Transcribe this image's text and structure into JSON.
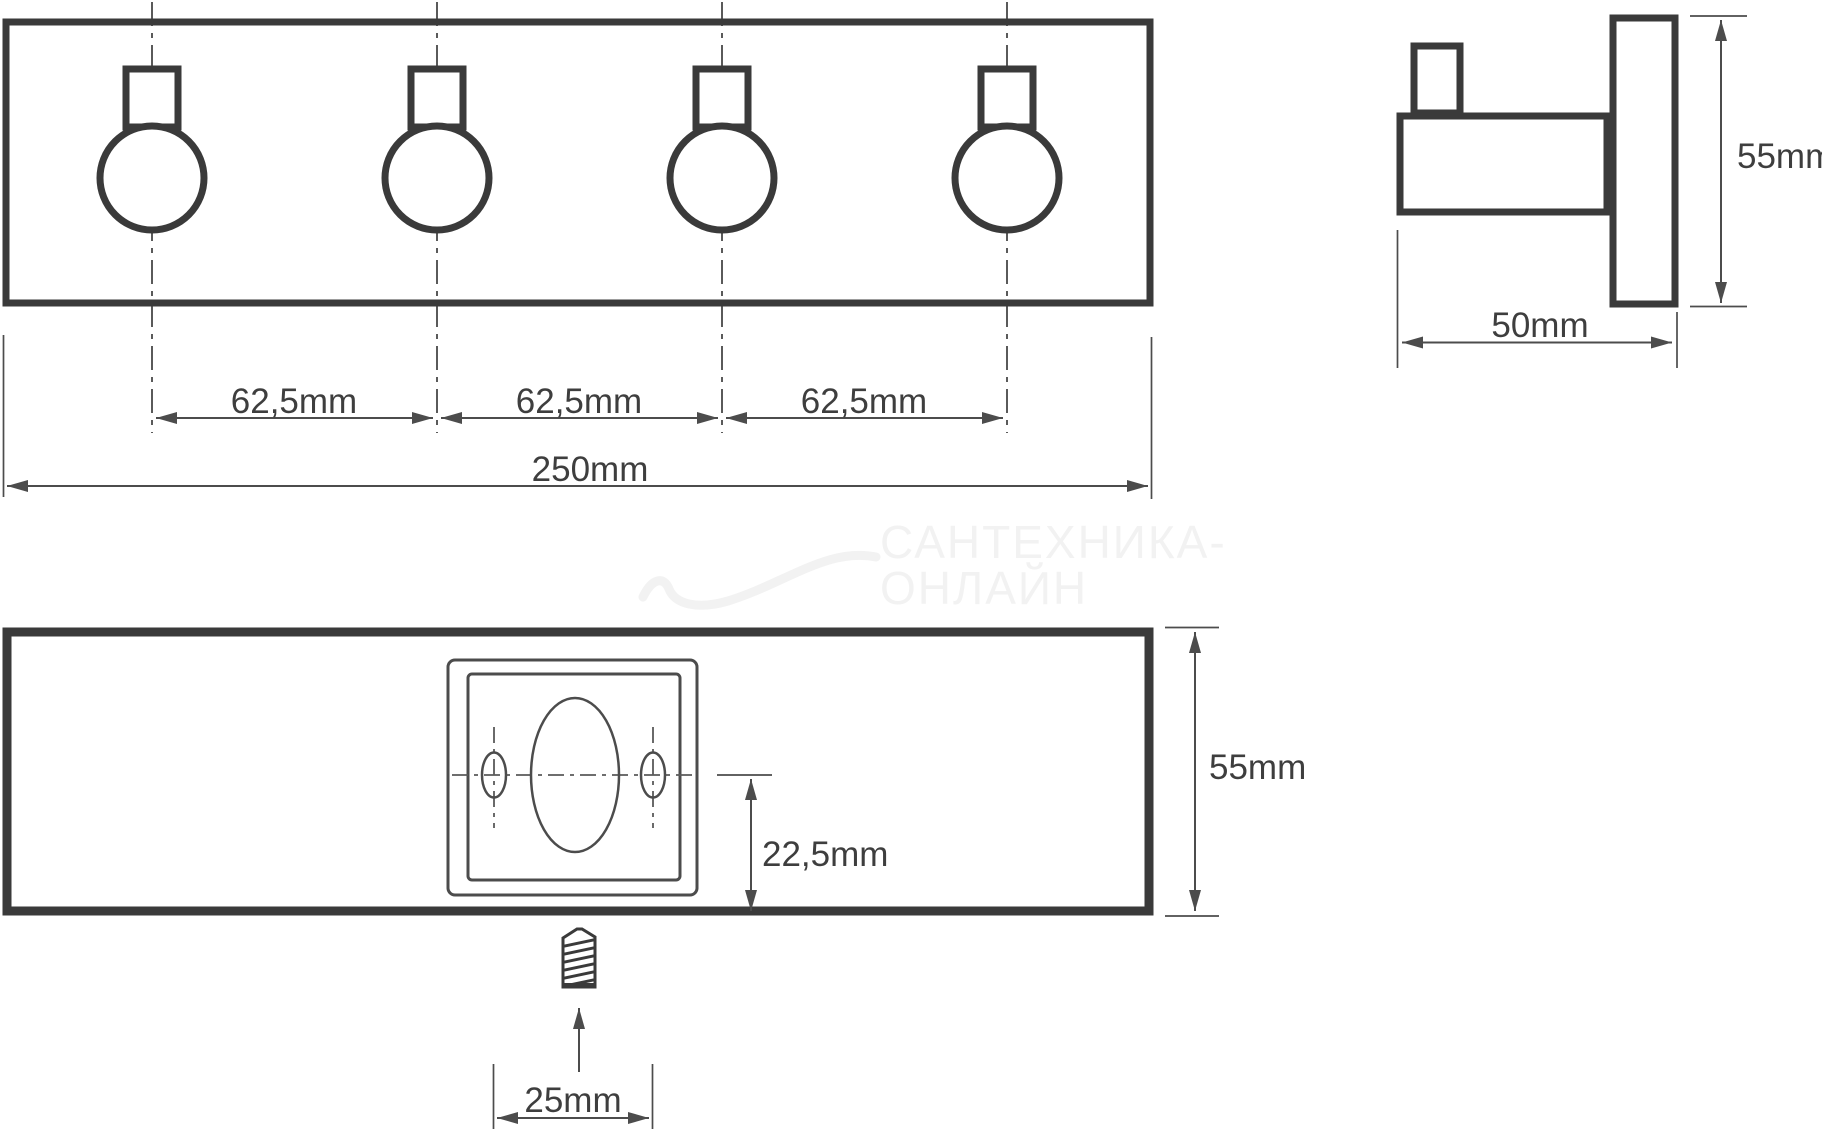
{
  "front_view": {
    "hook_spacing_labels": [
      "62,5mm",
      "62,5mm",
      "62,5mm"
    ],
    "total_width_label": "250mm"
  },
  "side_view": {
    "height_label": "55mm",
    "depth_label": "50mm"
  },
  "back_view": {
    "height_label": "55mm",
    "hole_offset_label": "22,5mm",
    "screw_spacing_label": "25mm"
  },
  "watermark": {
    "line1": "САНТЕХНИКА-",
    "line2": "ОНЛАЙН"
  },
  "colors": {
    "outline": "#3a3a3a",
    "dimension": "#4c4c4c",
    "text": "#3e3e3e",
    "watermark": "#f2f2f2"
  }
}
